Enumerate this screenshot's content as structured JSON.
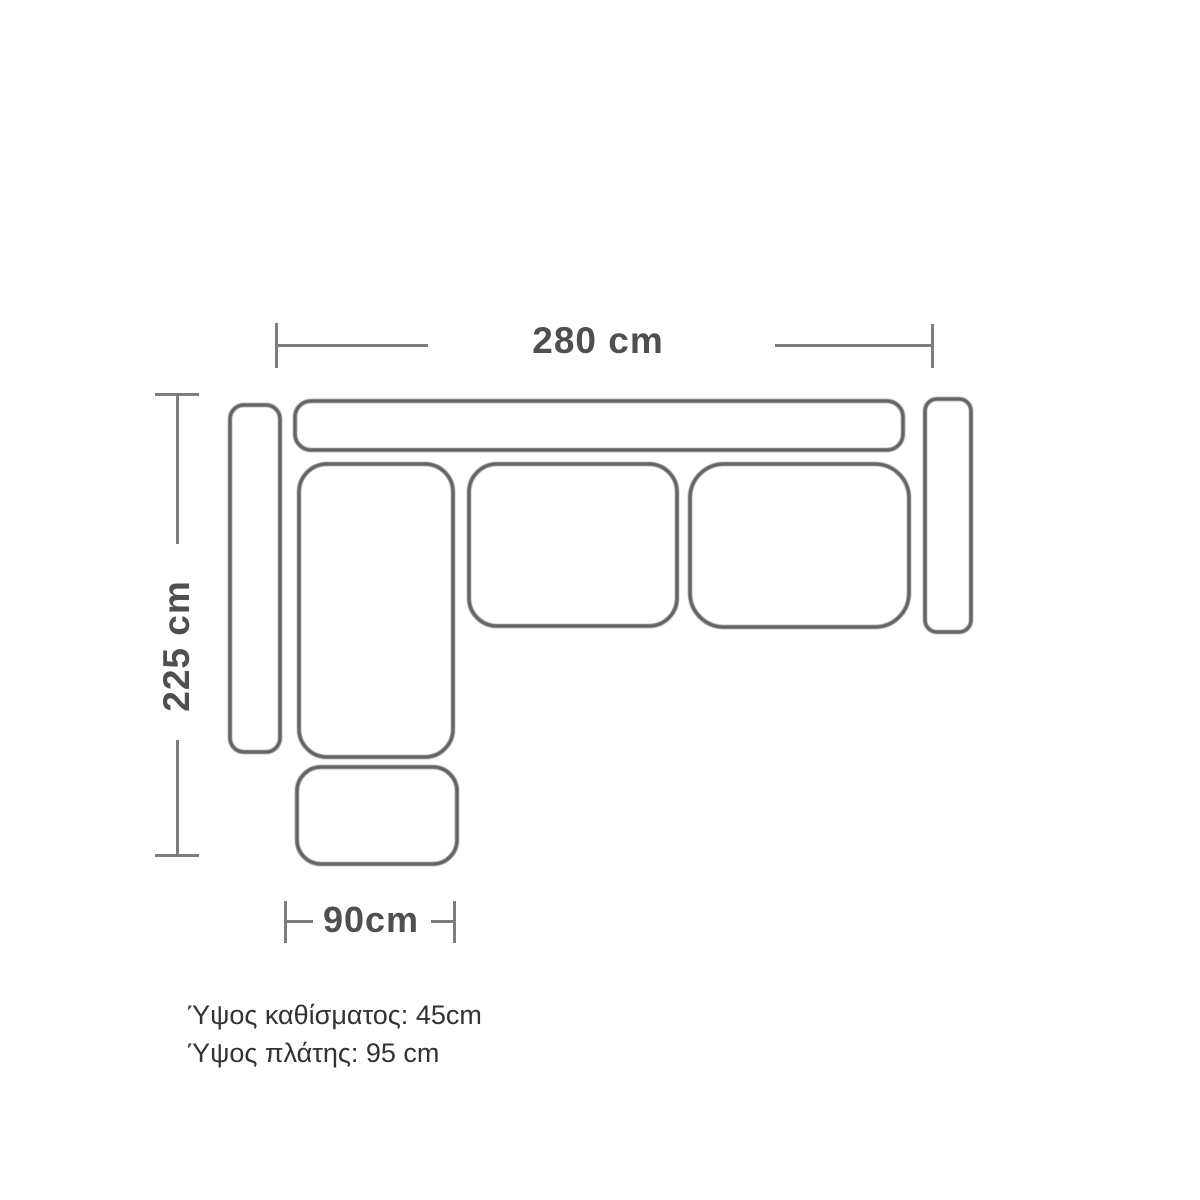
{
  "diagram": {
    "kind": "corner-sofa-top-view-dimension-drawing",
    "dimensions": {
      "top_width": "280 cm",
      "left_depth": "225 cm",
      "chaise_width": "90cm"
    },
    "notes": {
      "seat_height": "Ύψος καθίσματος: 45cm",
      "back_height": "Ύψος πλάτης: 95 cm"
    },
    "parts": [
      "backrest",
      "left-armrest",
      "right-armrest",
      "chaise-seat",
      "middle-seat-cushion",
      "right-seat-cushion",
      "ottoman"
    ],
    "colors": {
      "background": "#ffffff",
      "outline": "#636363",
      "dimension_line": "#7d7d7d",
      "dimension_text": "#4f4f4f",
      "note_text": "#333333"
    }
  }
}
